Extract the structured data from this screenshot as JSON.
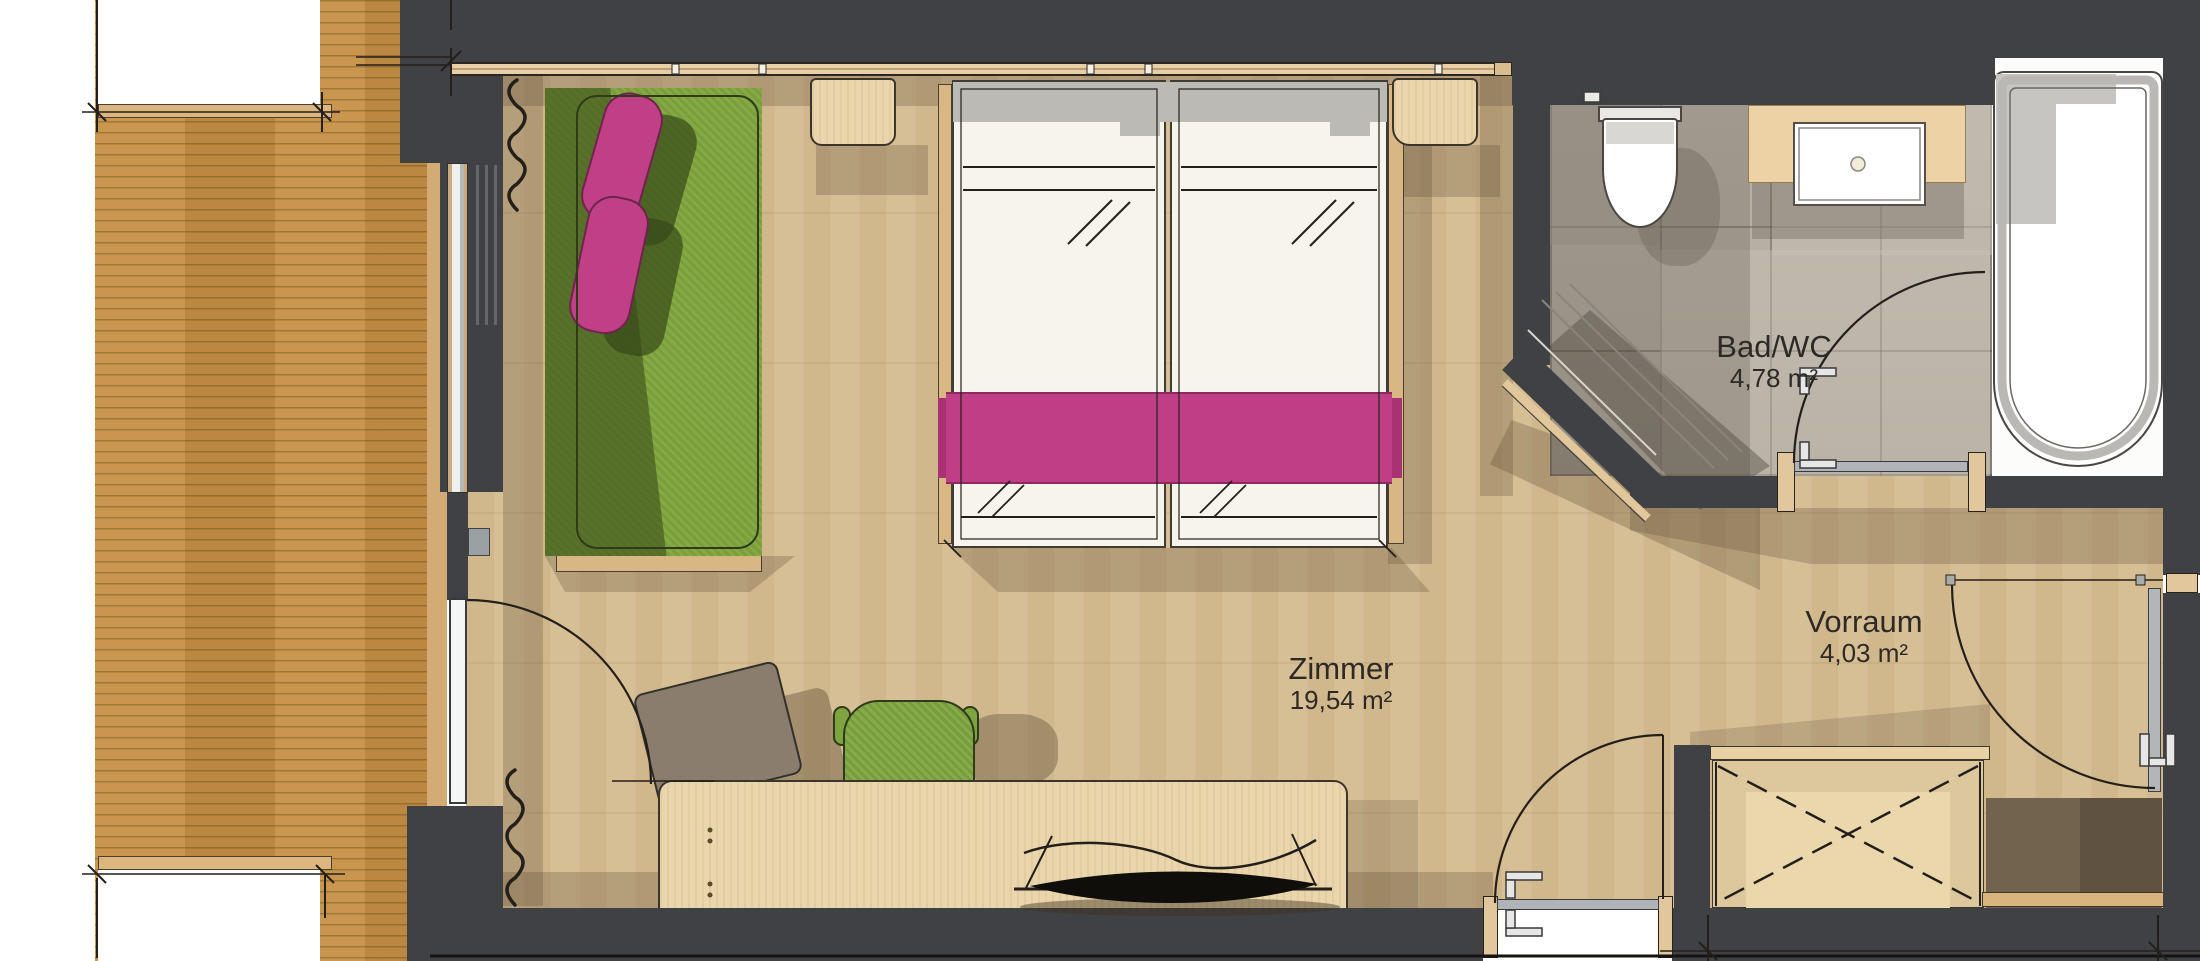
{
  "plan": {
    "type": "architectural-floor-plan",
    "rooms": [
      {
        "id": "zimmer",
        "name": "Zimmer",
        "area": "19,54 m²"
      },
      {
        "id": "bad_wc",
        "name": "Bad/WC",
        "area": "4,78 m²"
      },
      {
        "id": "vorraum",
        "name": "Vorraum",
        "area": "4,03 m²"
      }
    ],
    "icons": [
      "door-swing-arc-icon",
      "curtain-squiggle-icon",
      "wardrobe-cross-icon",
      "dimension-tick-icon",
      "door-handle-icon"
    ],
    "colors": {
      "wall": "#404144",
      "room_wood_floor": "#d7bf95",
      "terrace_wood": "#c69045",
      "bath_tile": "#b7b0a4",
      "sofa_green": "#7fa43c",
      "accent_magenta": "#bf3f85",
      "furniture_wood": "#e9d6ac",
      "bed_white": "#f6f4ed",
      "label_text": "#2d2a25"
    }
  }
}
